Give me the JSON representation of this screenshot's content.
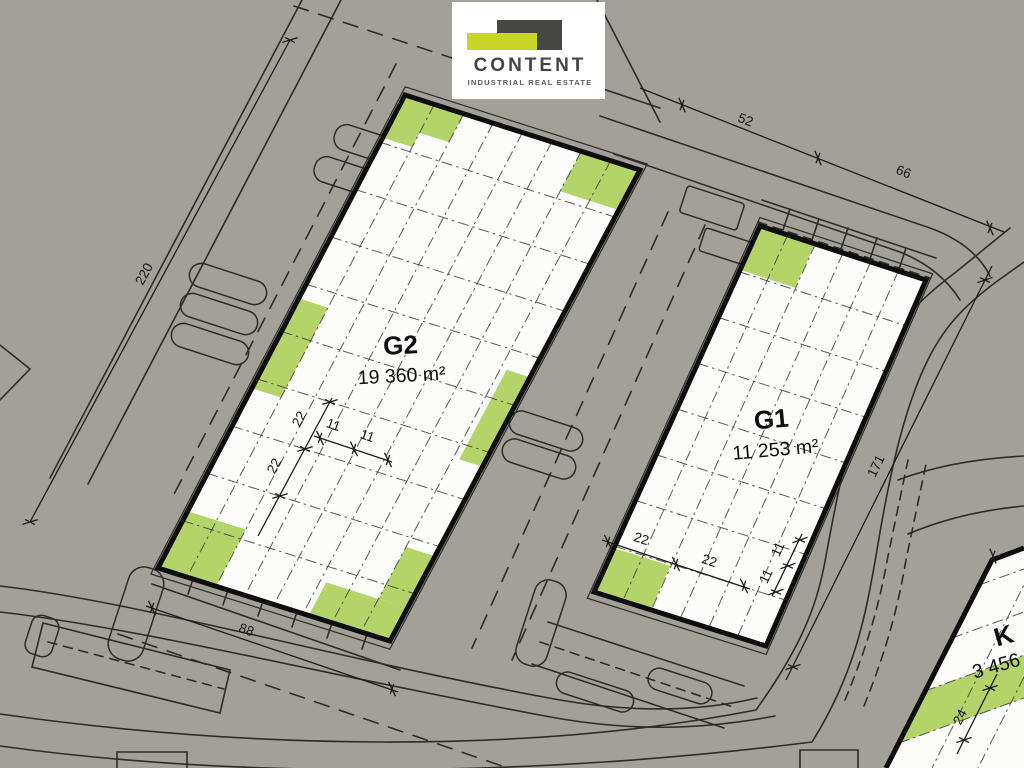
{
  "logo": {
    "brand": "CONTENT",
    "tagline": "INDUSTRIAL REAL ESTATE"
  },
  "buildings": {
    "g2": {
      "label": "G2",
      "area": "19 360 m²"
    },
    "g1": {
      "label": "G1",
      "area": "11 253 m²"
    },
    "k": {
      "label": "K",
      "area": "3 456"
    }
  },
  "dimensions": {
    "left_length": "220",
    "top_first": "52",
    "top_second": "66",
    "g2_width": "88",
    "g1_length": "171",
    "k_strip": "24",
    "g2_bay_long": [
      "22",
      "22"
    ],
    "g2_bay_short": [
      "11",
      "11"
    ],
    "g1_bay_long": [
      "22",
      "22"
    ],
    "g1_bay_short": [
      "11",
      "11"
    ]
  },
  "colors": {
    "background": "#a3a098",
    "building_fill": "#fcfcfa",
    "green": "#b4d469",
    "line": "#1c1c1c",
    "logo_card": "#ffffff",
    "logo_dark": "#474744",
    "logo_lime": "#c9d42b",
    "logo_text": "#454542",
    "logo_tagline": "#5d5d57"
  }
}
